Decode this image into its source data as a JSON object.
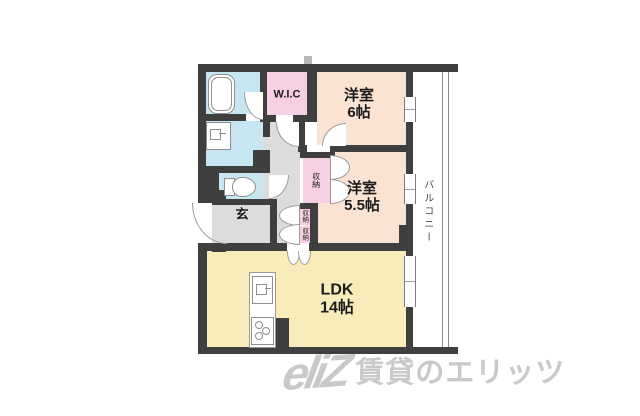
{
  "rooms": {
    "wic": {
      "label": "W.I.C"
    },
    "bedroom6": {
      "name": "洋室",
      "size": "6帖"
    },
    "bedroom55": {
      "name": "洋室",
      "size": "5.5帖"
    },
    "ldk": {
      "name": "LDK",
      "size": "14帖"
    },
    "genkan": {
      "label": "玄"
    },
    "balcony": {
      "label": "バルコニー"
    },
    "closet_main": {
      "label": "収納"
    },
    "closet_hall_upper": {
      "label": "収納"
    },
    "closet_hall_lower": {
      "label": "収納"
    }
  },
  "watermark": {
    "logo": "eliZ",
    "text": "賃貸のエリッツ"
  },
  "colors": {
    "wall": "#3f3f3f",
    "peach": "#fae3d3",
    "pink": "#f6cfe3",
    "yellow": "#f8edba",
    "blue": "#c6e6f2",
    "gray": "#dcdcdc",
    "watermark_gray": "#c9c9c9"
  }
}
